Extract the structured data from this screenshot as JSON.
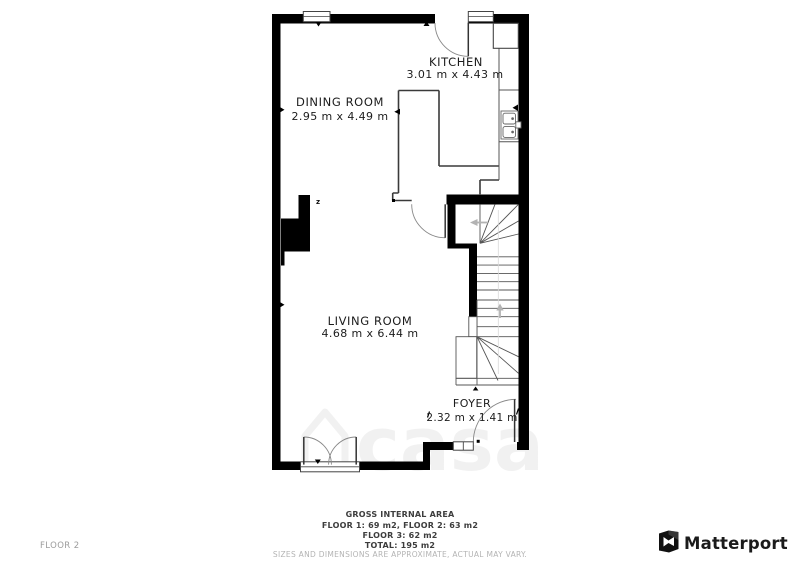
{
  "plan": {
    "floor_label": "FLOOR 2",
    "rooms": [
      {
        "name": "KITCHEN",
        "dimensions": "3.01 m x 4.43 m"
      },
      {
        "name": "DINING ROOM",
        "dimensions": "2.95 m x 4.49 m"
      },
      {
        "name": "LIVING ROOM",
        "dimensions": "4.68 m x 6.44 m"
      },
      {
        "name": "FOYER",
        "dimensions": "2.32 m x 1.41 m"
      }
    ],
    "wall_note": "z"
  },
  "footer": {
    "title": "GROSS INTERNAL AREA",
    "line1": "FLOOR 1: 69 m2, FLOOR 2: 63 m2",
    "line2": "FLOOR 3: 62 m2",
    "line3": "TOTAL: 195 m2",
    "disclaimer": "SIZES AND DIMENSIONS ARE APPROXIMATE, ACTUAL MAY VARY."
  },
  "branding": {
    "logo_text": "Matterport"
  },
  "watermark": {
    "text": "casa"
  },
  "colors": {
    "wall": "#000000",
    "thin_wall": "#3a3a3a",
    "stair_line": "#555555",
    "door_arc": "#888888",
    "arrow": "#b3b3b3",
    "footer_muted": "#b4b4b4",
    "floor_label": "#9c9c9c"
  }
}
